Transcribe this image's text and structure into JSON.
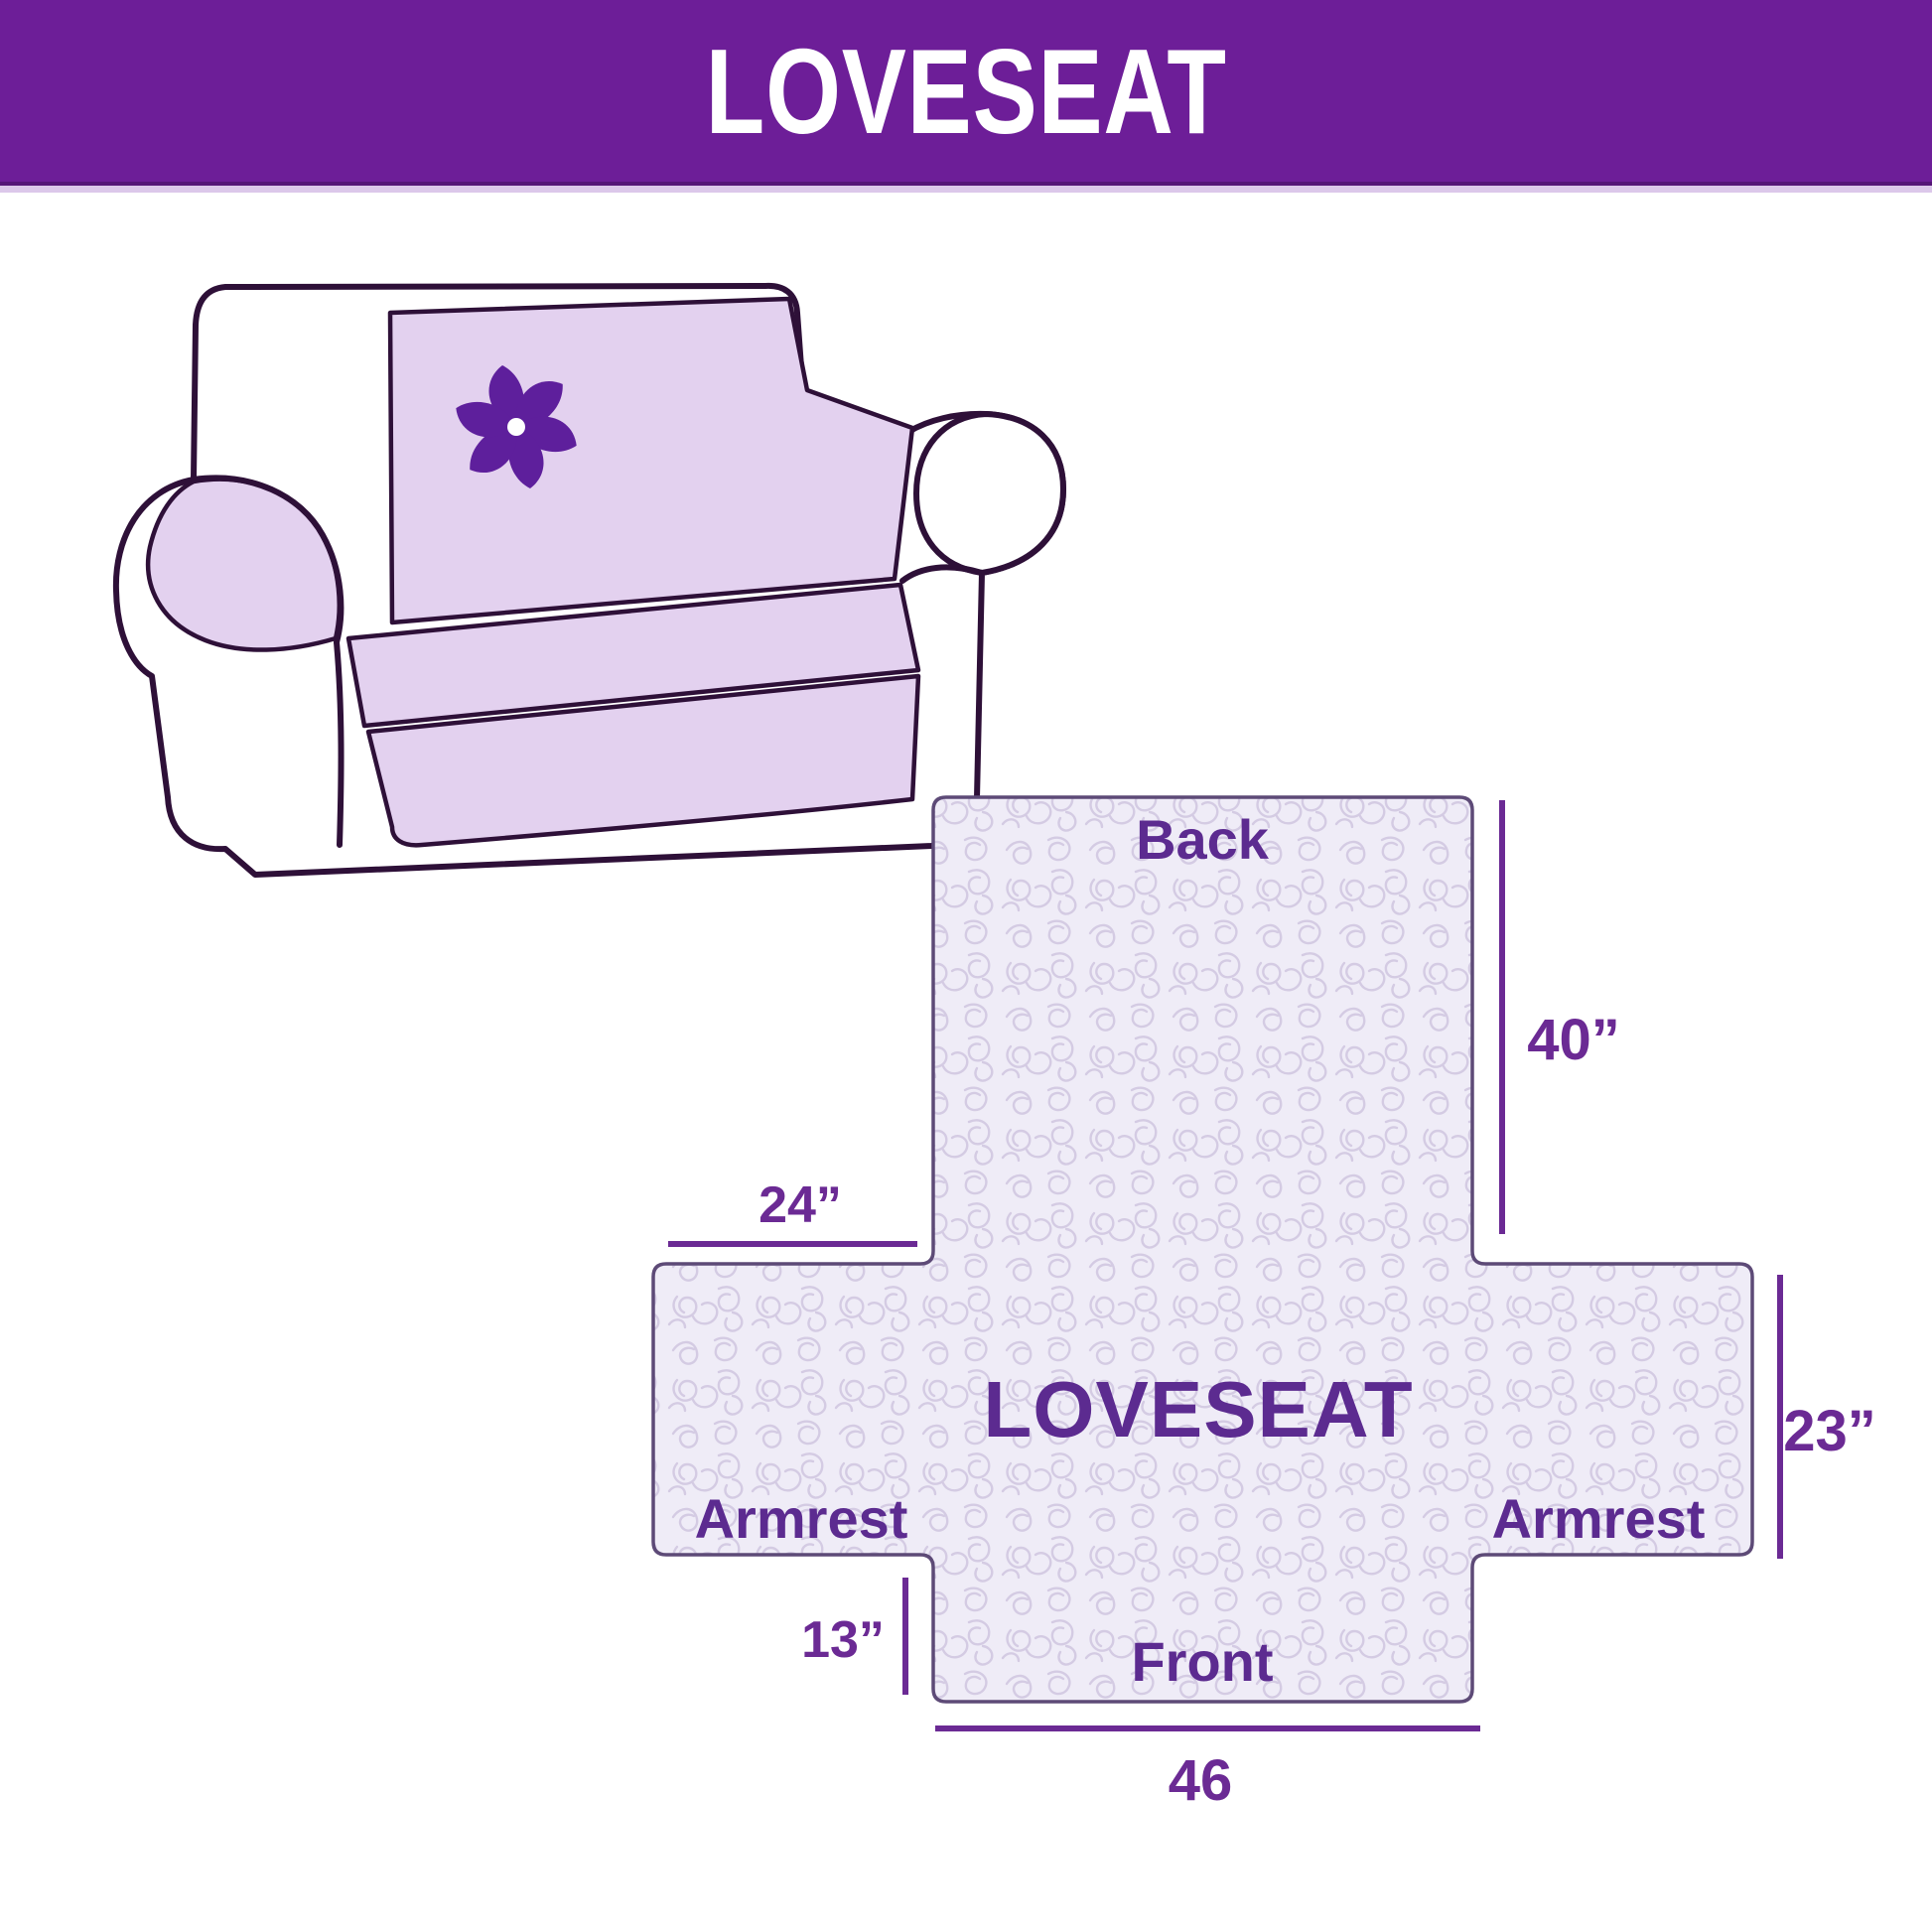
{
  "header": {
    "title": "LOVESEAT",
    "background_color": "#6d1e98",
    "text_color": "#ffffff"
  },
  "illustration": {
    "description": "line-drawn loveseat sofa wearing a light purple slipcover",
    "logo": "pinwheel-logo",
    "cover_color": "#e3d1ef",
    "outline_color": "#2e1038",
    "logo_color": "#5e1f9c"
  },
  "diagram": {
    "center_label": "LOVESEAT",
    "back_label": "Back",
    "front_label": "Front",
    "armrest_left_label": "Armrest",
    "armrest_right_label": "Armrest",
    "dim_armrest_top": "24”",
    "dim_back_height": "40”",
    "dim_side": "23”",
    "dim_front_side": "13”",
    "dim_front_width": "46",
    "quilt_fill_color": "#efecf7",
    "quilt_pattern_color": "#d4cbe3",
    "shape_outline_color": "#5d4a77",
    "dimension_line_color": "#6b2a94",
    "label_color": "#5c2b90"
  }
}
